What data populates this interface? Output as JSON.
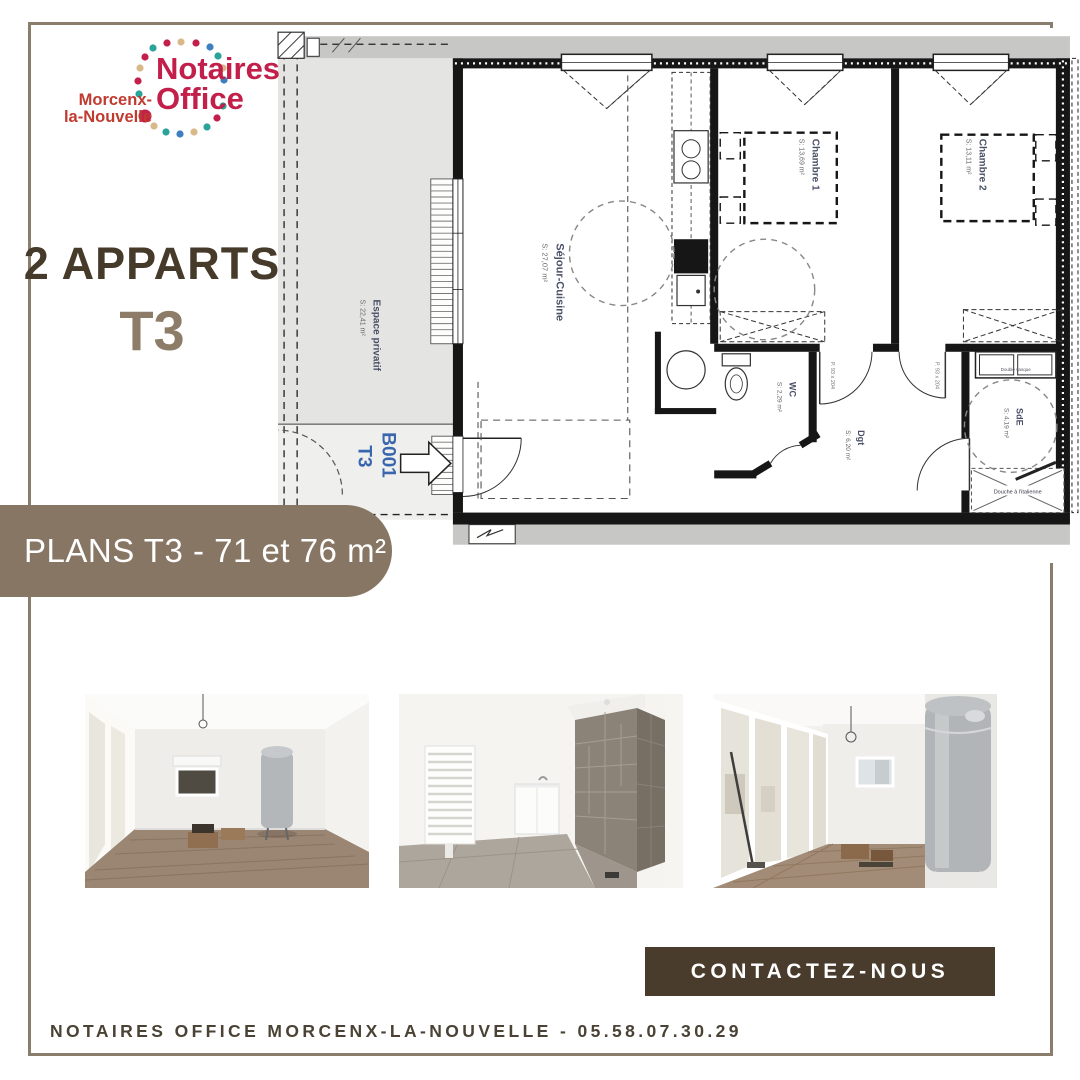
{
  "logo": {
    "brand_line1": "Notaires",
    "brand_line2": "Office",
    "location_line1": "Morcenx-",
    "location_line2": "la-Nouvelle",
    "brand_color": "#c2204a",
    "dot_colors": [
      "#c2204a",
      "#2aa39b",
      "#d9b98a",
      "#3f7fc1"
    ]
  },
  "headline": {
    "line1": "2 APPARTS",
    "line2": "T3"
  },
  "banner": {
    "label": "PLANS T3 - 71 et 76 m²",
    "bg": "#877663"
  },
  "plan": {
    "unit": {
      "code": "B001",
      "type": "T3"
    },
    "espace": {
      "name": "Espace privatif",
      "area": "S: 22,41 m²"
    },
    "sejour": {
      "name": "Séjour-Cuisine",
      "area": "S: 27,07 m²"
    },
    "chambre1": {
      "name": "Chambre 1",
      "area": "S: 13,69 m²"
    },
    "chambre2": {
      "name": "Chambre 2",
      "area": "S: 13,11 m²"
    },
    "wc": {
      "name": "WC",
      "area": "S: 2,29 m²"
    },
    "dgt": {
      "name": "Dgt",
      "area": "S: 6,20 m²"
    },
    "sde": {
      "name": "SdE",
      "area": "S: 4,19 m²"
    },
    "vasque": "Double vasque",
    "douche": "Douche à l'italienne",
    "door_note": "P. 93 x 204"
  },
  "cta": {
    "label": "CONTACTEZ-NOUS",
    "bg": "#4a3c2c"
  },
  "footer": {
    "text": "NOTAIRES OFFICE MORCENX-LA-NOUVELLE - 05.58.07.30.29"
  }
}
